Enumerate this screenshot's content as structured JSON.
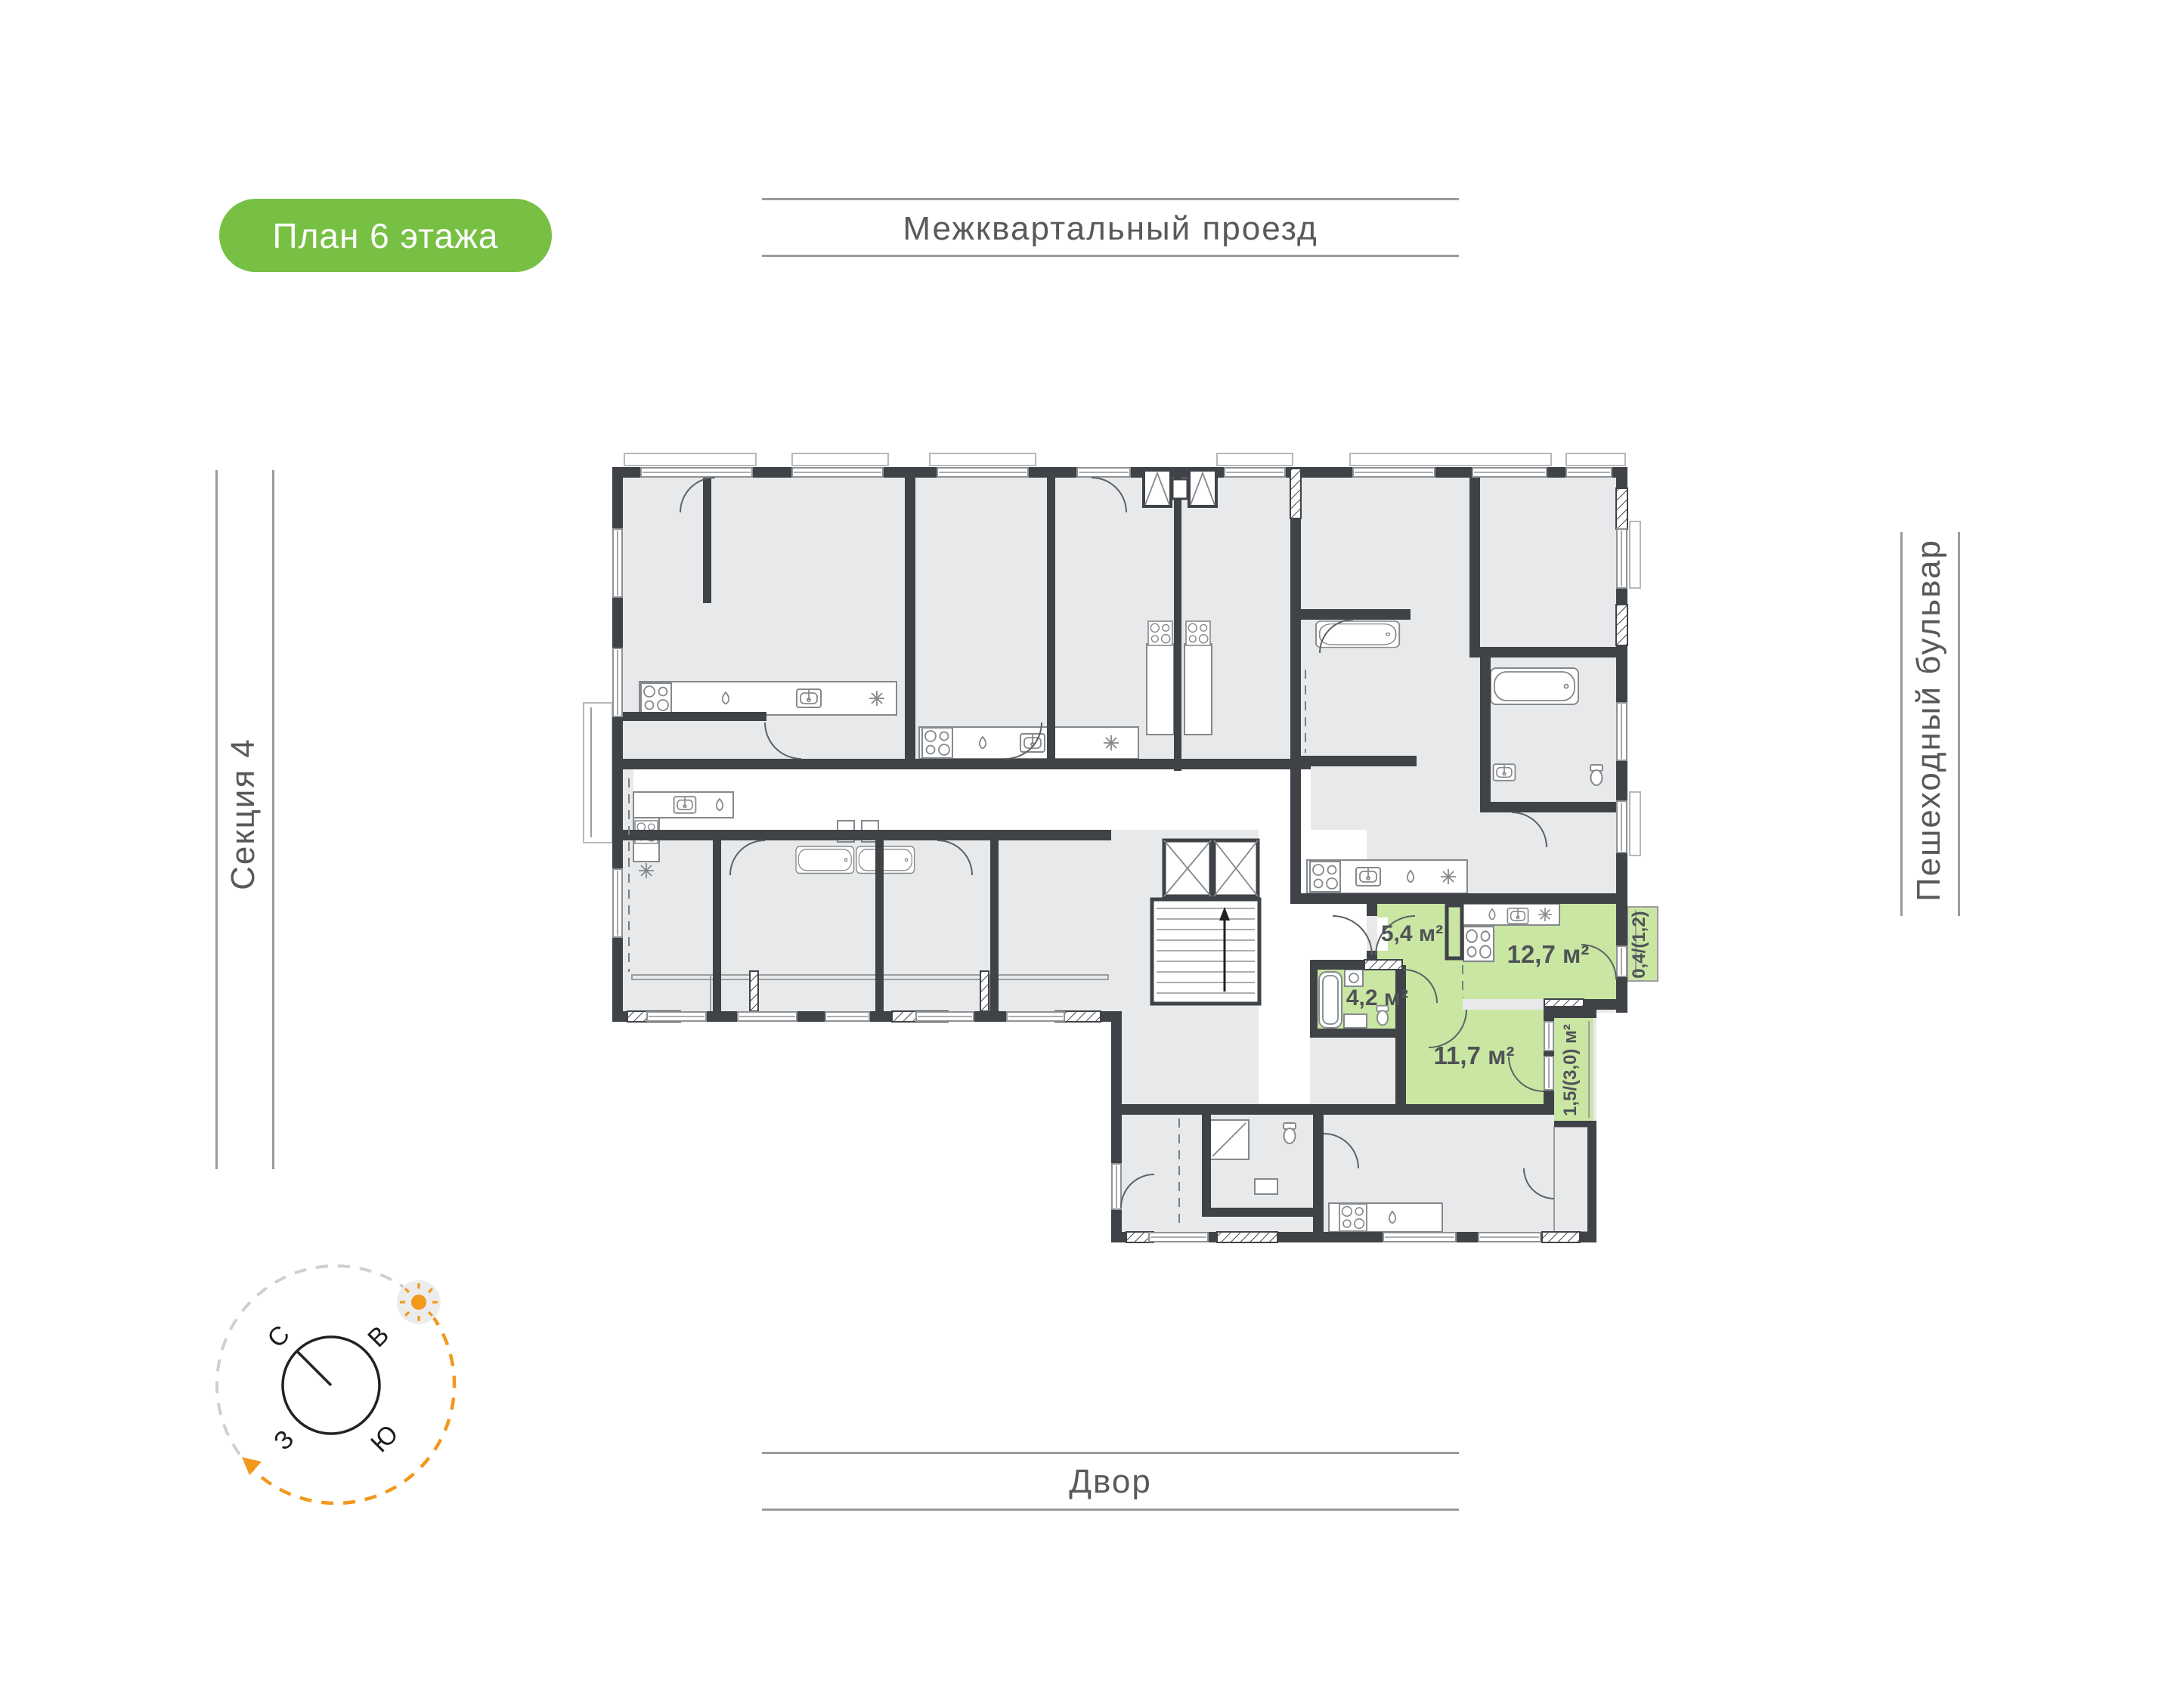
{
  "badge": {
    "label": "План 6 этажа",
    "color": "#77c044"
  },
  "surroundings": {
    "top_label": "Межквартальный проезд",
    "bottom_label": "Двор",
    "left_label": "Секция 4",
    "right_label": "Пешеходный бульвар"
  },
  "compass": {
    "north": "С",
    "east": "В",
    "west": "З",
    "south": "Ю"
  },
  "highlighted_apartment": {
    "fill_color": "#c9e6a3",
    "rooms": [
      {
        "name": "hallway",
        "area_label": "5,4 м²"
      },
      {
        "name": "kitchen-living",
        "area_label": "12,7 м²"
      },
      {
        "name": "bathroom",
        "area_label": "4,2 м²"
      },
      {
        "name": "bedroom",
        "area_label": "11,7 м²"
      }
    ],
    "balconies": [
      {
        "name": "kitchen-balcony",
        "area_label": "0,4/(1,2)"
      },
      {
        "name": "bedroom-balcony",
        "area_label": "1,5/(3,0) м²"
      }
    ]
  },
  "plan_colors": {
    "walls": "#3f4347",
    "rooms": "#e8e9ea",
    "accent_orange": "#f2981d",
    "lines": "#9b9b9b"
  }
}
